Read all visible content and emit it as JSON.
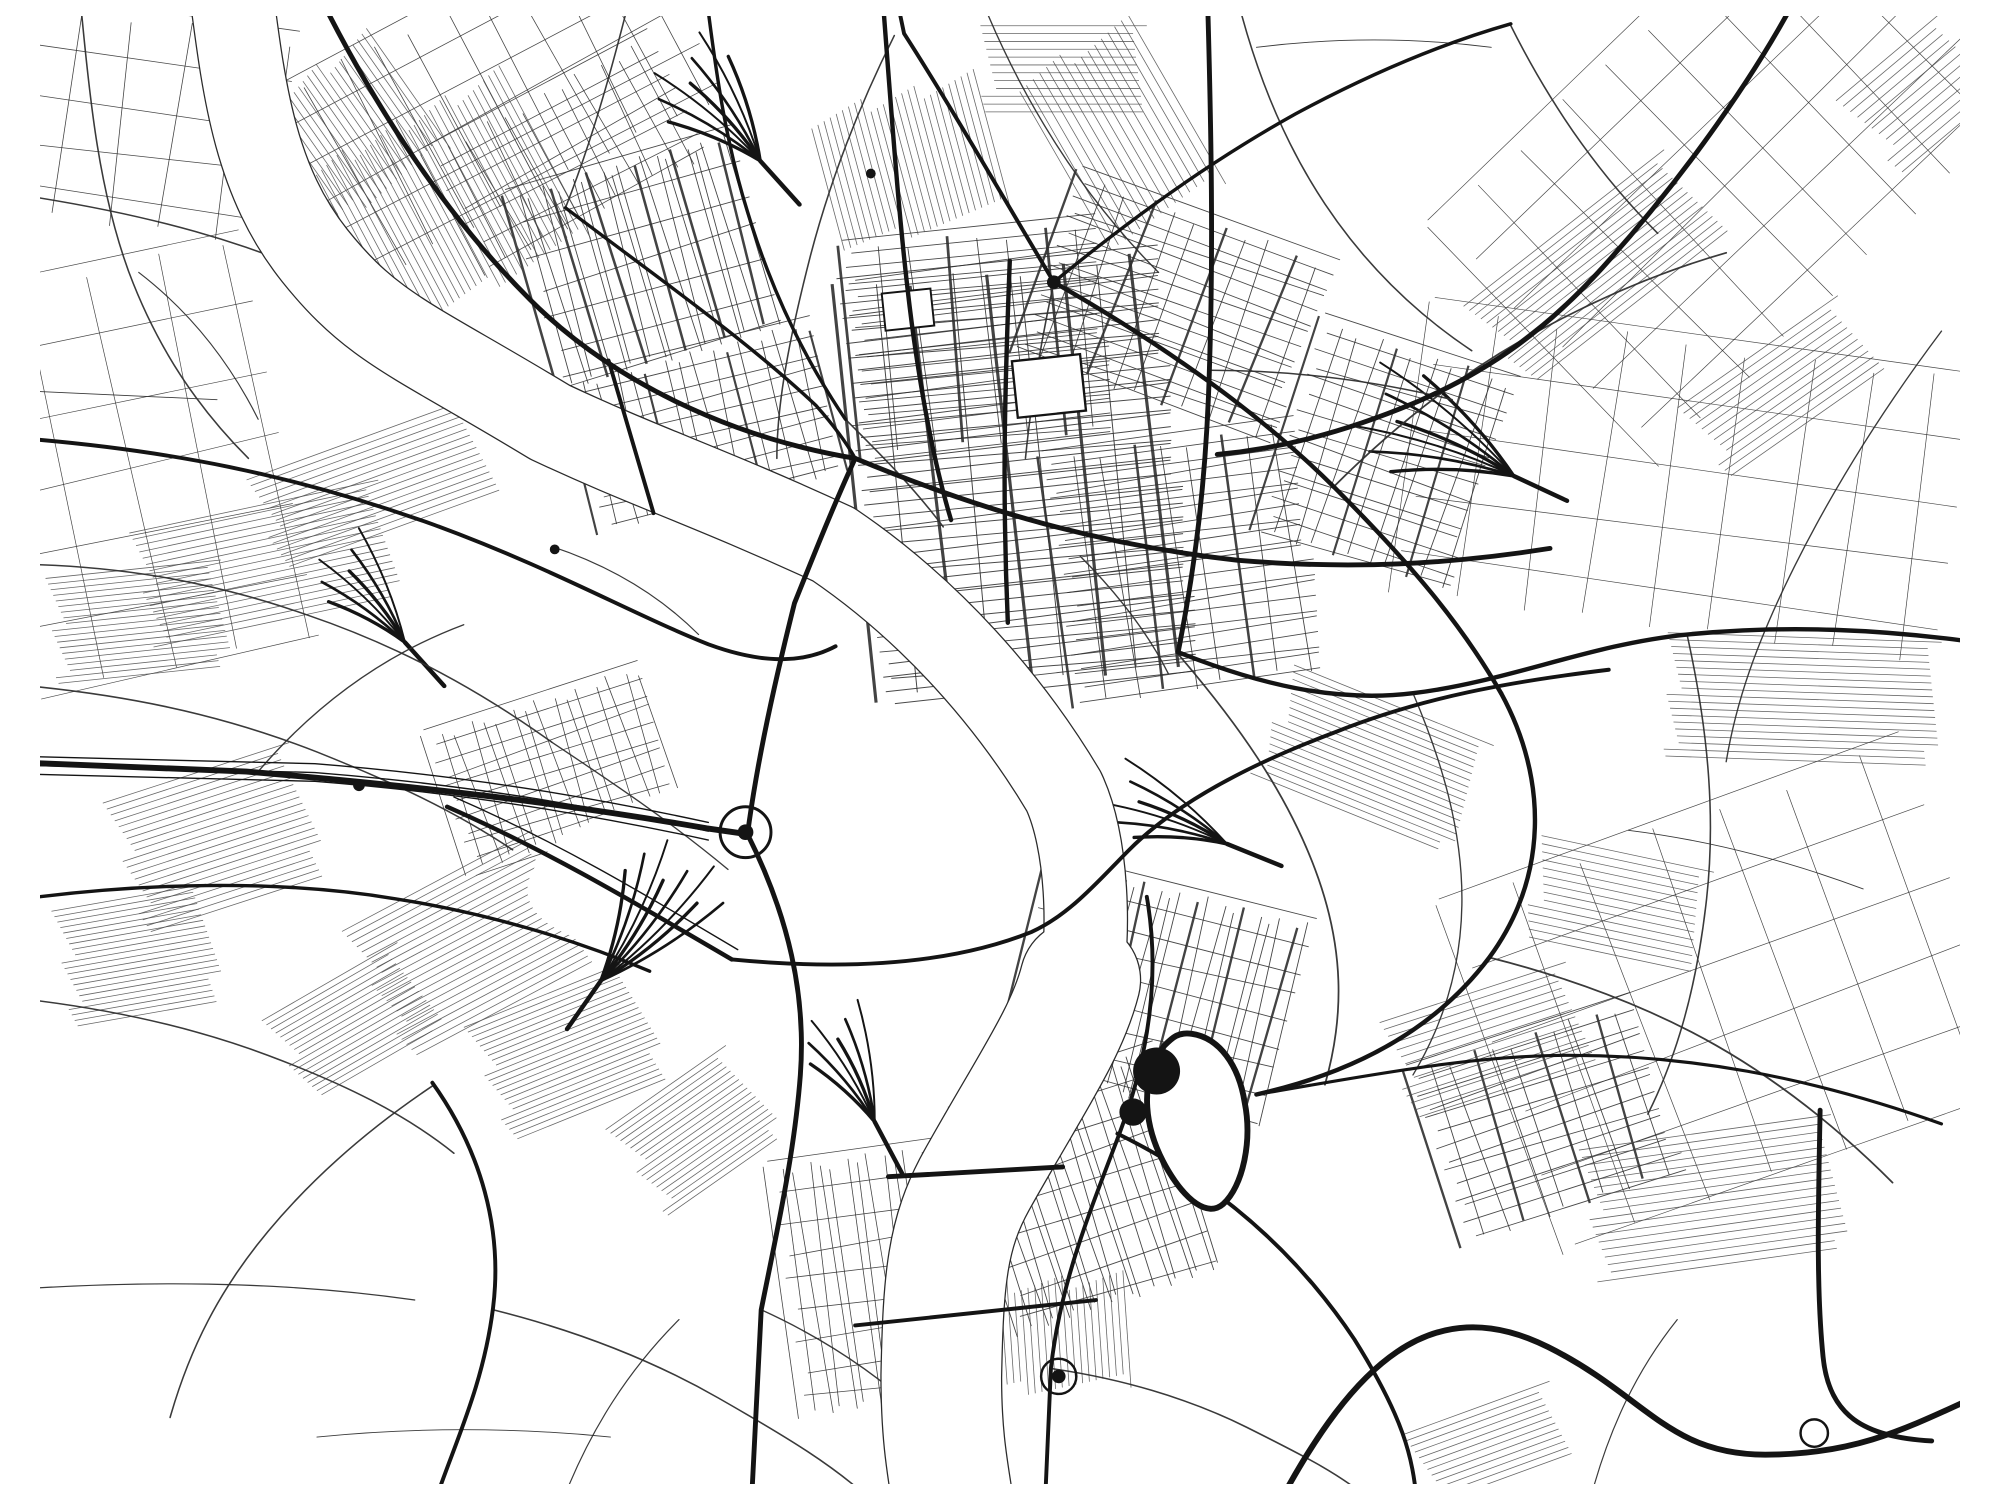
{
  "meta": {
    "canvas": {
      "w": 2000,
      "h": 1500
    },
    "palette": {
      "background": "#ffffff",
      "ink": "#141414",
      "minor": "#2f2f2f",
      "faint": "#4d4d4d",
      "water_edge": "#2b2b2b",
      "water_fill": "#ffffff"
    }
  },
  "map": {
    "river": {
      "edge_pad": 2.6,
      "segments": [
        {
          "d": "M 215,-20 C 228,80 240,170 300,245 C 360,320 400,330 540,415 C 640,462 700,480 830,540 C 930,608 1010,700 1065,792 C 1090,845 1092,940 1082,992",
          "w": 84
        },
        {
          "d": "M 1082,985 C 1068,1040 1032,1090 976,1190 C 946,1244 942,1290 940,1390 C 940,1450 946,1482 952,1520",
          "w": 122
        }
      ]
    },
    "grids": [
      {
        "x": 1020,
        "y": 470,
        "w": 330,
        "h": 430,
        "r": -6,
        "sx": 38,
        "sy": 10,
        "lw": 1,
        "em": 2,
        "lw2": 3.2
      },
      {
        "x": 980,
        "y": 330,
        "w": 260,
        "h": 220,
        "r": -6,
        "sx": 34,
        "sy": 11,
        "lw": 0.9,
        "em": 3,
        "lw2": 2.8
      },
      {
        "x": 1190,
        "y": 560,
        "w": 260,
        "h": 260,
        "r": -8,
        "sx": 30,
        "sy": 12,
        "lw": 0.9,
        "em": 3,
        "lw2": 2.6
      },
      {
        "x": 1180,
        "y": 300,
        "w": 280,
        "h": 200,
        "r": 20,
        "sx": 26,
        "sy": 13,
        "lw": 0.9,
        "em": 3,
        "lw2": 2.4
      },
      {
        "x": 640,
        "y": 250,
        "w": 240,
        "h": 210,
        "r": -16,
        "sx": 11,
        "sy": 34,
        "lw": 0.9,
        "em": 4,
        "lw2": 2.6
      },
      {
        "x": 560,
        "y": 140,
        "w": 260,
        "h": 140,
        "r": -28,
        "sx": 22,
        "sy": 22,
        "lw": 0.8
      },
      {
        "x": 700,
        "y": 420,
        "w": 260,
        "h": 160,
        "r": -14,
        "sx": 17,
        "sy": 17,
        "lw": 0.9,
        "em": 5,
        "lw2": 2.2
      },
      {
        "x": 545,
        "y": 770,
        "w": 230,
        "h": 150,
        "r": -18,
        "sx": 15,
        "sy": 15,
        "lw": 0.8
      },
      {
        "x": 1160,
        "y": 1000,
        "w": 280,
        "h": 220,
        "r": 14,
        "sx": 13,
        "sy": 26,
        "lw": 0.9,
        "em": 4,
        "lw2": 2.4
      },
      {
        "x": 1090,
        "y": 1200,
        "w": 220,
        "h": 240,
        "r": -18,
        "sx": 12,
        "sy": 28,
        "lw": 0.9
      },
      {
        "x": 880,
        "y": 1290,
        "w": 200,
        "h": 260,
        "r": -8,
        "sx": 13,
        "sy": 30,
        "lw": 0.8
      },
      {
        "x": 470,
        "y": 90,
        "w": 460,
        "h": 220,
        "r": -28,
        "sx": 40,
        "sy": 40,
        "lw": 0.8
      },
      {
        "x": 1760,
        "y": 140,
        "w": 560,
        "h": 340,
        "r": -44,
        "sx": 60,
        "sy": 60,
        "lw": 0.7
      },
      {
        "x": 120,
        "y": 460,
        "w": 300,
        "h": 420,
        "r": -12,
        "sx": 70,
        "sy": 70,
        "lw": 0.7
      },
      {
        "x": 1700,
        "y": 480,
        "w": 560,
        "h": 300,
        "r": 8,
        "sx": 65,
        "sy": 65,
        "lw": 0.7
      },
      {
        "x": 1750,
        "y": 1000,
        "w": 500,
        "h": 380,
        "r": -20,
        "sx": 75,
        "sy": 75,
        "lw": 0.7
      },
      {
        "x": 130,
        "y": 110,
        "w": 280,
        "h": 220,
        "r": 8,
        "sx": 55,
        "sy": 48,
        "lw": 0.8
      },
      {
        "x": 1395,
        "y": 450,
        "w": 210,
        "h": 230,
        "r": 18,
        "sx": 20,
        "sy": 16,
        "lw": 0.9,
        "em": 4,
        "lw2": 2.2
      },
      {
        "x": 1560,
        "y": 1130,
        "w": 240,
        "h": 190,
        "r": -18,
        "sx": 22,
        "sy": 14,
        "lw": 0.9,
        "em": 3,
        "lw2": 2.4
      }
    ],
    "hatches": [
      {
        "x": 420,
        "y": 200,
        "w": 200,
        "h": 260,
        "r": 62,
        "s": 7
      },
      {
        "x": 330,
        "y": 120,
        "w": 150,
        "h": 160,
        "r": 55,
        "s": 7
      },
      {
        "x": 250,
        "y": 560,
        "w": 260,
        "h": 120,
        "r": -12,
        "s": 7
      },
      {
        "x": 360,
        "y": 480,
        "w": 240,
        "h": 100,
        "r": -20,
        "s": 7
      },
      {
        "x": 120,
        "y": 620,
        "w": 180,
        "h": 110,
        "r": -6,
        "s": 6
      },
      {
        "x": 200,
        "y": 840,
        "w": 200,
        "h": 140,
        "r": -18,
        "s": 7
      },
      {
        "x": 120,
        "y": 960,
        "w": 160,
        "h": 120,
        "r": -10,
        "s": 6
      },
      {
        "x": 460,
        "y": 950,
        "w": 220,
        "h": 150,
        "r": -28,
        "s": 7
      },
      {
        "x": 560,
        "y": 1060,
        "w": 180,
        "h": 130,
        "r": -22,
        "s": 6
      },
      {
        "x": 905,
        "y": 150,
        "w": 150,
        "h": 180,
        "r": 75,
        "s": 7
      },
      {
        "x": 1120,
        "y": 120,
        "w": 200,
        "h": 140,
        "r": 60,
        "s": 9
      },
      {
        "x": 1610,
        "y": 260,
        "w": 260,
        "h": 110,
        "r": -38,
        "s": 7
      },
      {
        "x": 1820,
        "y": 700,
        "w": 280,
        "h": 130,
        "r": 2,
        "s": 7
      },
      {
        "x": 1380,
        "y": 760,
        "w": 220,
        "h": 120,
        "r": 22,
        "s": 7
      },
      {
        "x": 1010,
        "y": 1350,
        "w": 120,
        "h": 240,
        "r": 86,
        "s": 7
      },
      {
        "x": 1730,
        "y": 1210,
        "w": 260,
        "h": 140,
        "r": -8,
        "s": 8
      },
      {
        "x": 340,
        "y": 1030,
        "w": 160,
        "h": 100,
        "r": -30,
        "s": 6
      },
      {
        "x": 1500,
        "y": 1050,
        "w": 200,
        "h": 110,
        "r": -18,
        "s": 8
      },
      {
        "x": 690,
        "y": 1140,
        "w": 150,
        "h": 110,
        "r": -35,
        "s": 6
      },
      {
        "x": 1065,
        "y": 55,
        "w": 170,
        "h": 90,
        "r": 0,
        "s": 8
      },
      {
        "x": 1800,
        "y": 380,
        "w": 200,
        "h": 90,
        "r": -35,
        "s": 8
      },
      {
        "x": 1630,
        "y": 910,
        "w": 180,
        "h": 110,
        "r": 12,
        "s": 8
      },
      {
        "x": 1940,
        "y": 80,
        "w": 140,
        "h": 100,
        "r": -40,
        "s": 9
      },
      {
        "x": 1500,
        "y": 1460,
        "w": 160,
        "h": 80,
        "r": -20,
        "s": 7
      }
    ],
    "patches_pre": [
      {
        "cx": 770,
        "cy": 862,
        "rx": 255,
        "ry": 92,
        "rot": -8
      }
    ],
    "fans": [
      {
        "x": 755,
        "y": 148,
        "a": 228,
        "sp": 50,
        "n": 7,
        "len": 150
      },
      {
        "x": 592,
        "y": 986,
        "a": -55,
        "sp": 45,
        "n": 8,
        "len": 170
      },
      {
        "x": 392,
        "y": 640,
        "a": -132,
        "sp": 40,
        "n": 6,
        "len": 130
      },
      {
        "x": 1525,
        "y": 470,
        "a": 205,
        "sp": 46,
        "n": 7,
        "len": 185
      },
      {
        "x": 1232,
        "y": 846,
        "a": -158,
        "sp": 36,
        "n": 6,
        "len": 140
      },
      {
        "x": 872,
        "y": 1130,
        "a": -118,
        "sp": 40,
        "n": 6,
        "len": 130
      }
    ],
    "secondary": [
      {
        "d": "M -20,180 C 120,200 240,230 362,292",
        "w": 1.6
      },
      {
        "d": "M 60,-20 C 70,90 80,180 110,262 C 140,342 182,402 232,452",
        "w": 1.6
      },
      {
        "d": "M -20,560 C 90,560 190,576 292,612 C 392,646 472,692 542,742",
        "w": 1.6
      },
      {
        "d": "M -20,682 C 100,692 200,712 302,752 C 382,784 442,812 502,852",
        "w": 1.6
      },
      {
        "d": "M 242,772 C 302,702 372,652 452,622",
        "w": 1.4
      },
      {
        "d": "M 542,742 C 602,782 662,822 722,872",
        "w": 1.4
      },
      {
        "d": "M 842,412 C 882,452 912,482 942,522",
        "w": 1.6
      },
      {
        "d": "M 1340,482 C 1400,422 1462,372 1532,332 C 1602,292 1672,262 1742,242",
        "w": 1.8
      },
      {
        "d": "M 1214,362 C 1300,362 1380,372 1462,392",
        "w": 1.6
      },
      {
        "d": "M 1182,652 C 1242,722 1292,792 1322,872 C 1352,952 1352,1022 1332,1092",
        "w": 1.8
      },
      {
        "d": "M 1500,962 C 1580,982 1662,1012 1732,1052 C 1802,1092 1862,1142 1912,1192",
        "w": 1.8
      },
      {
        "d": "M 1702,632 C 1722,722 1732,812 1722,902 C 1712,992 1692,1062 1662,1122",
        "w": 1.6
      },
      {
        "d": "M 422,1092 C 362,1132 302,1182 252,1242 C 202,1302 172,1362 152,1432",
        "w": 1.6
      },
      {
        "d": "M 482,1322 C 562,1342 642,1372 712,1412 C 782,1452 832,1482 872,1520",
        "w": 1.6
      },
      {
        "d": "M 756,1322 C 822,1352 882,1392 932,1442",
        "w": 1.4
      },
      {
        "d": "M 1052,1382 C 1122,1392 1192,1412 1252,1442 C 1312,1472 1352,1492 1382,1520",
        "w": 1.6
      },
      {
        "d": "M 892,20 C 852,100 822,180 802,262 C 782,342 772,402 772,452",
        "w": 1.6
      },
      {
        "d": "M 1522,10 C 1562,90 1612,162 1672,222",
        "w": 1.6
      },
      {
        "d": "M -20,1002 C 80,1012 172,1032 252,1062 C 332,1092 392,1122 442,1162",
        "w": 1.6
      },
      {
        "d": "M 1962,322 C 1902,402 1852,482 1812,562 C 1772,642 1752,702 1742,762",
        "w": 1.4
      },
      {
        "d": "M 1422,692 C 1452,762 1472,832 1472,902 C 1472,972 1452,1032 1422,1082",
        "w": 1.4
      },
      {
        "d": "M 1055,272 C 1042,332 1032,392 1026,452",
        "w": 1.6
      },
      {
        "d": "M 622,-20 C 602,60 582,130 556,196",
        "w": 1.6
      },
      {
        "d": "M 1242,-20 C 1262,60 1292,132 1332,192 C 1372,252 1422,302 1482,342",
        "w": 1.6
      },
      {
        "d": "M -20,1302 C 120,1292 262,1292 402,1312",
        "w": 1.2
      },
      {
        "d": "M 552,1520 C 582,1442 622,1382 672,1332",
        "w": 1.2
      },
      {
        "d": "M 1602,1520 C 1622,1442 1652,1382 1692,1332",
        "w": 1.2
      },
      {
        "d": "M 120,262 C 172,302 212,352 242,412",
        "w": 1.2
      },
      {
        "d": "M 980,-20 C 1020,80 1080,180 1162,262",
        "w": 1.4
      },
      {
        "d": "M -20,382 L 200,392",
        "w": 0.9
      },
      {
        "d": "M 1262,32 C 1342,22 1422,22 1502,32",
        "w": 0.9
      },
      {
        "d": "M 1642,832 C 1722,842 1802,862 1882,892",
        "w": 0.9
      },
      {
        "d": "M 302,1452 C 402,1442 502,1442 602,1452",
        "w": 0.9
      },
      {
        "d": "M 1082,552 C 1122,592 1152,632 1172,672",
        "w": 1.4
      },
      {
        "d": "M 542,542 C 602,562 652,592 692,632",
        "w": 1.2
      }
    ],
    "rails_under": [
      {
        "d": "M -20,756 L 300,764 C 452,776 582,798 702,824",
        "w": 1.4
      },
      {
        "d": "M -20,765 L 300,773 C 452,785 582,807 702,833",
        "w": 1.4
      },
      {
        "d": "M -20,774 L 300,782 C 452,794 582,816 702,842",
        "w": 1.4
      },
      {
        "d": "M 442,798 C 548,844 638,898 732,954",
        "w": 1.4
      }
    ],
    "patches_post": [
      {
        "x": 1050,
        "y": 378,
        "w": 70,
        "h": 58,
        "r": -6,
        "sw": 2.4
      },
      {
        "x": 906,
        "y": 300,
        "w": 50,
        "h": 38,
        "r": -6,
        "sw": 2
      }
    ],
    "arterials": [
      {
        "d": "M 305,-20 C 360,90 430,200 520,290 C 600,370 720,430 852,452",
        "w": 5
      },
      {
        "d": "M 852,452 C 830,500 810,550 790,600 C 770,680 752,760 742,836",
        "w": 5
      },
      {
        "d": "M 852,452 C 980,505 1100,540 1242,556 C 1360,566 1462,560 1562,544",
        "w": 5
      },
      {
        "d": "M 880,-20 C 890,110 898,230 912,330 C 922,400 934,462 950,515",
        "w": 4.5
      },
      {
        "d": "M 1055,272 C 1160,332 1262,402 1342,482 C 1420,560 1472,622 1512,692",
        "w": 4.5
      },
      {
        "d": "M 1055,272 C 1000,180 952,96 902,18 L 894,-20",
        "w": 4
      },
      {
        "d": "M 1055,272 C 1130,210 1212,150 1302,100 C 1380,58 1452,28 1522,8",
        "w": 3.5
      },
      {
        "d": "M 1010,250 C 1005,380 1002,480 1008,620",
        "w": 4.5
      },
      {
        "d": "M 1212,-20 C 1216,120 1218,240 1214,360 C 1211,470 1200,560 1182,650",
        "w": 5
      },
      {
        "d": "M 1512,692 C 1560,780 1560,880 1500,962 C 1440,1042 1352,1082 1262,1102",
        "w": 4.5
      },
      {
        "d": "M 1150,900 C 1164,980 1152,1062 1122,1142 C 1092,1222 1062,1292 1052,1382 L 1046,1520",
        "w": 4
      },
      {
        "d": "M 886,1186 L 1064,1176",
        "w": 5
      },
      {
        "d": "M 852,1338 L 1098,1312",
        "w": 4
      },
      {
        "d": "M 1285,1520 C 1360,1380 1440,1300 1560,1360 C 1660,1410 1682,1470 1782,1470 C 1880,1470 1932,1440 2012,1404",
        "w": 6
      },
      {
        "d": "M 1838,1118 C 1836,1220 1834,1300 1841,1370 C 1847,1430 1882,1452 1952,1456",
        "w": 5
      },
      {
        "d": "M 1814,-20 C 1772,60 1702,160 1622,250 C 1562,318 1502,362 1422,396 C 1350,426 1286,442 1222,448",
        "w": 5
      },
      {
        "d": "M 600,352 L 646,508",
        "w": 4
      },
      {
        "d": "M 556,196 C 640,260 740,330 812,398 C 828,416 842,434 852,452",
        "w": 3.5
      },
      {
        "d": "M -20,430 C 150,442 282,470 422,520 C 542,564 622,610 702,642 C 762,664 802,660 832,644",
        "w": 4
      },
      {
        "d": "M 420,1090 C 470,1160 492,1240 482,1320 C 472,1400 442,1460 422,1520",
        "w": 4
      },
      {
        "d": "M 1120,1142 C 1222,1192 1302,1262 1362,1352 C 1412,1432 1422,1472 1426,1520",
        "w": 4
      },
      {
        "d": "M 1262,1102 C 1380,1082 1482,1062 1582,1062 C 1700,1062 1822,1082 1962,1132",
        "w": 3.2
      },
      {
        "d": "M 1182,650 C 1262,682 1342,702 1422,692 C 1520,680 1602,642 1702,632 C 1802,622 1902,626 2012,642",
        "w": 4.5
      },
      {
        "d": "M 700,-20 C 710,60 720,130 742,200 C 766,280 800,350 842,412",
        "w": 3.5
      },
      {
        "d": "M -20,762 L 230,772 C 420,788 562,806 700,830 L 742,836",
        "w": 6
      },
      {
        "d": "M 435,808 C 540,854 630,908 726,964",
        "w": 4.5
      },
      {
        "d": "M 726,964 C 850,976 952,968 1032,936 C 1072,918 1102,882 1132,852 C 1182,802 1262,762 1342,732 C 1432,696 1522,680 1622,668",
        "w": 4
      },
      {
        "d": "M -20,905 C 120,885 262,882 382,902 C 472,916 562,942 642,976",
        "w": 3.5
      },
      {
        "d": "M 742,836 C 784,920 802,1000 796,1082 C 790,1162 772,1242 756,1322 L 746,1520",
        "w": 5
      }
    ],
    "pond": {
      "d": "M 1168,1052 C 1140,1090 1148,1140 1172,1180 C 1190,1210 1212,1228 1228,1214 C 1248,1196 1258,1150 1250,1110 C 1244,1072 1224,1044 1196,1040 C 1182,1038 1176,1044 1168,1052 Z",
      "w": 6,
      "blobs": [
        {
          "cx": 1160,
          "cy": 1078,
          "r": 24
        },
        {
          "cx": 1136,
          "cy": 1120,
          "r": 14
        }
      ]
    },
    "rings": [
      {
        "x": 740,
        "y": 834,
        "r": 26,
        "w": 3
      },
      {
        "x": 1060,
        "y": 1390,
        "r": 18,
        "w": 2.5
      },
      {
        "x": 1832,
        "y": 1448,
        "r": 14,
        "w": 2.5
      }
    ],
    "dots": [
      {
        "x": 1055,
        "y": 272,
        "r": 7
      },
      {
        "x": 740,
        "y": 834,
        "r": 8
      },
      {
        "x": 345,
        "y": 786,
        "r": 6
      },
      {
        "x": 868,
        "y": 161,
        "r": 5
      },
      {
        "x": 545,
        "y": 545,
        "r": 5
      },
      {
        "x": 1060,
        "y": 1390,
        "r": 7
      }
    ]
  }
}
